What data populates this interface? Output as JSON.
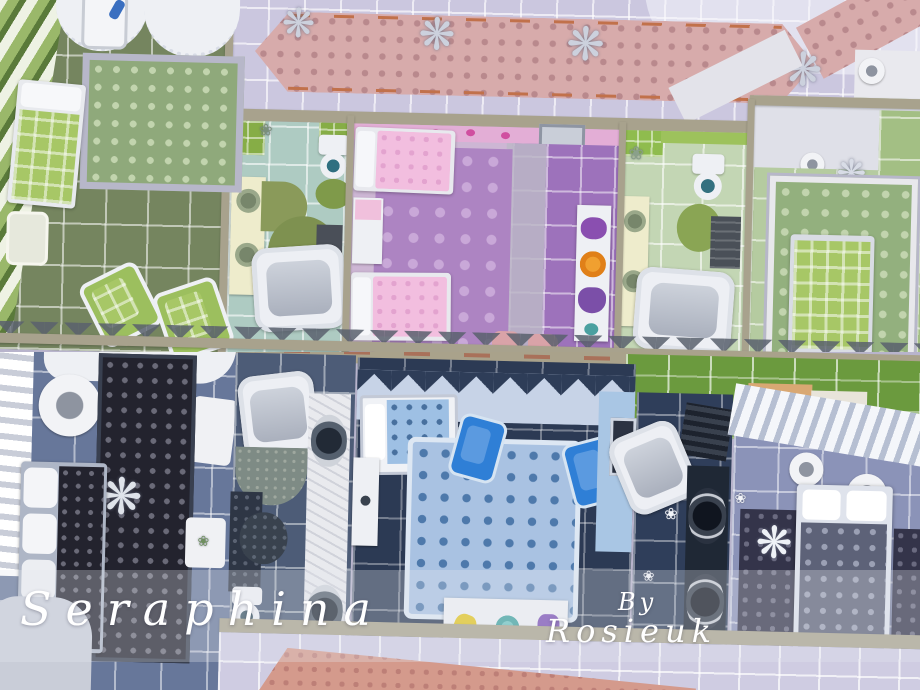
{
  "overlay": {
    "title": "Seraphina",
    "credit_prefix": "By",
    "credit_name": "Rosieuk"
  },
  "glyphs": {
    "chandelier": "❋",
    "flower": "❀"
  },
  "palette": {
    "hallway_tile": "#cbc7df",
    "runner_pink": "#d7abab",
    "runner_trim_orange": "#c1714b",
    "wall_tan": "#a8a28d",
    "olive_floor": "#75855f",
    "mint_tile": "#aecbc2",
    "lime_accent": "#86ad46",
    "pink_floor": "#d5aed2",
    "purple_tile": "#9d72bb",
    "lilac_rug": "#ad84c2",
    "green_floor": "#b5cba0",
    "slate_tile": "#67779a",
    "navy_tile": "#2c3a54",
    "kids_rug_blue": "#a9c2e2",
    "armchair_blue": "#2f7fd6",
    "grass_green": "#6b9a3e",
    "overlay_text": "#ffffff"
  },
  "scene": {
    "upper_panel_rooms": [
      "green-bedroom-left",
      "mint-bathroom",
      "pink-kids-bedroom",
      "green-bathroom",
      "green-bedroom-right",
      "lavender-hallway"
    ],
    "lower_panel_rooms": [
      "slate-bedroom-left",
      "slate-bathroom",
      "blue-kids-bedroom",
      "dark-bathroom",
      "periwinkle-bedroom",
      "garden-strip"
    ]
  }
}
